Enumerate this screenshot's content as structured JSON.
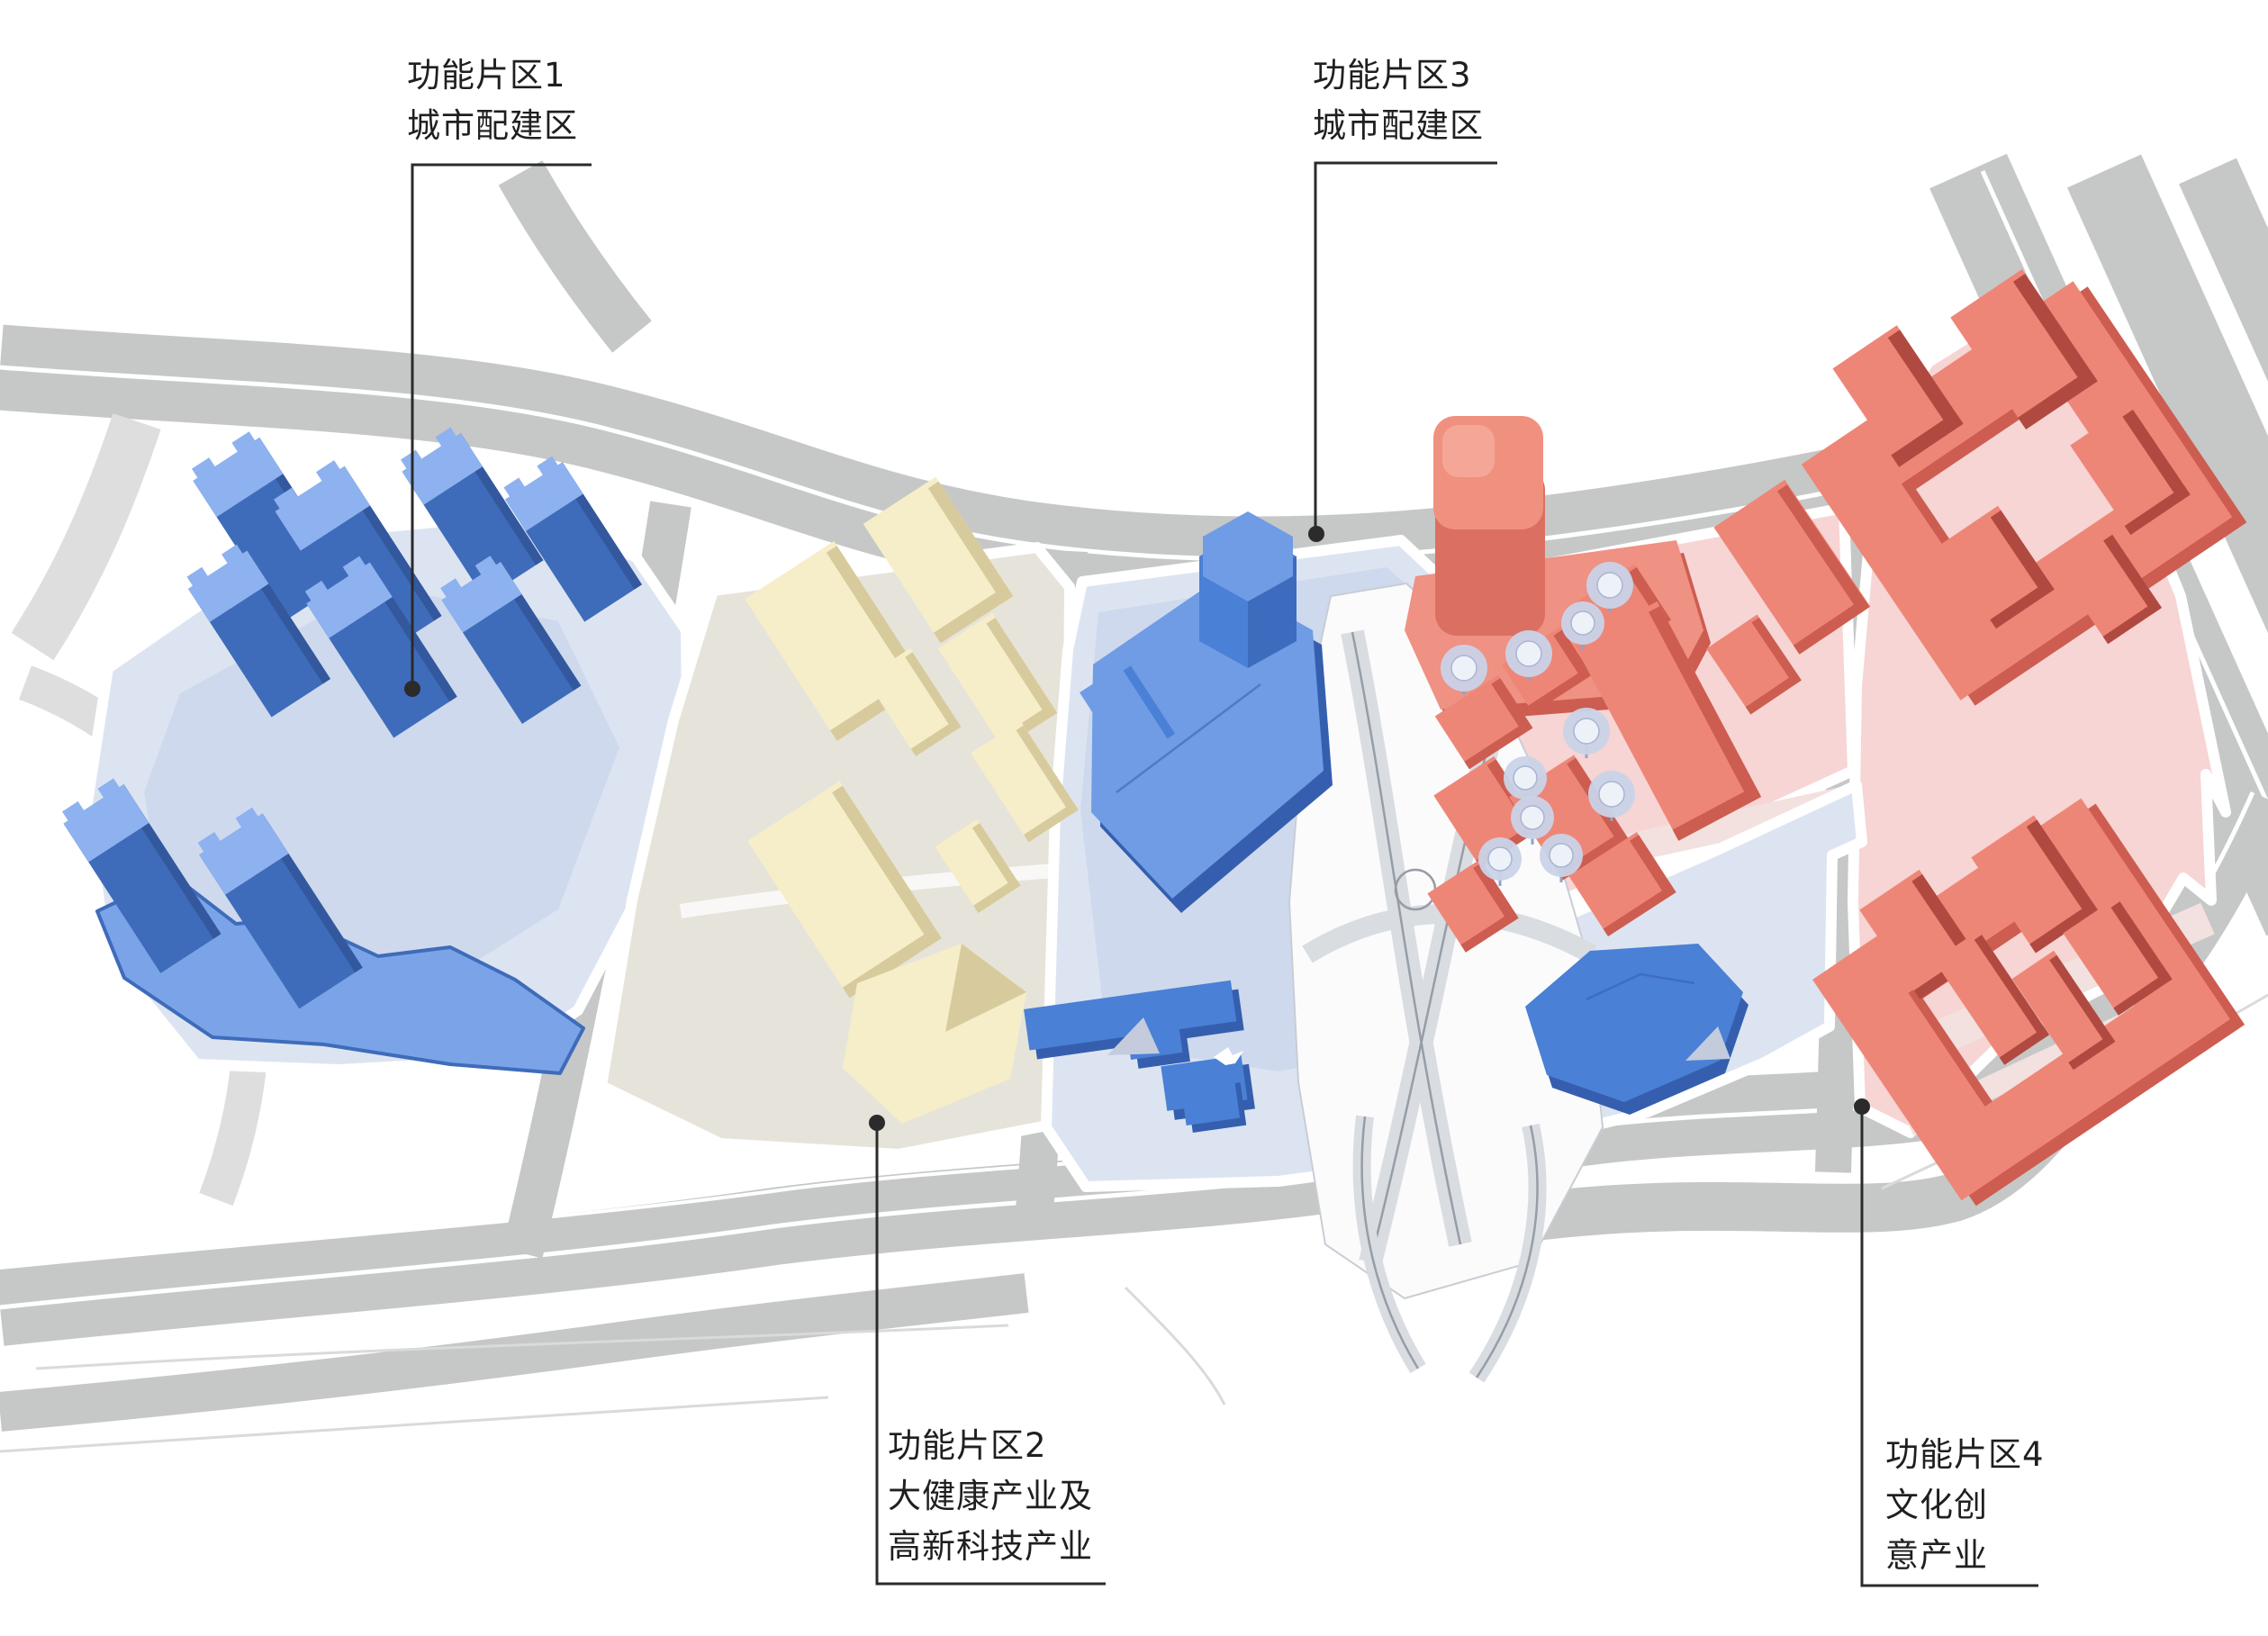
{
  "labels": [
    {
      "id": "zone-1",
      "lines": [
        "功能片区1",
        "城市配建区"
      ]
    },
    {
      "id": "zone-2",
      "lines": [
        "功能片区2",
        "大健康产业及",
        "高新科技产业"
      ]
    },
    {
      "id": "zone-3",
      "lines": [
        "功能片区3",
        "城市配建区"
      ]
    },
    {
      "id": "zone-4",
      "lines": [
        "功能片区4",
        "文化创",
        "意产业"
      ]
    }
  ],
  "colors": {
    "background": "#ffffff",
    "text": "#1f1f1f",
    "leader": "#2b2b2b",
    "road": "#c6c7c7",
    "road_light": "#dedede",
    "faint": "#dadada",
    "parcel_blue": "#dde4f1",
    "parcel_blue_inner": "#cbd7ec",
    "parcel_cream": "#e6e4da",
    "parcel_pink": "#f6d5d4",
    "pink_stripe": "#f2e1df",
    "wedge": "#fbfbfc",
    "interchange_band": "#d9dce1",
    "interchange_line": "#979da6",
    "blue_body": "#3e6cba",
    "blue_roof": "#8db2ef",
    "blue_dark": "#33589d",
    "blue_podium": "#7ba4e8",
    "bright_blue_body": "#4a80d6",
    "bright_blue_roof": "#6f9ce4",
    "bright_blue_dark": "#355fae",
    "cream_roof": "#f6eec9",
    "cream_side": "#d7cb9e",
    "red_roof": "#ee8677",
    "red_side": "#cd5d51",
    "red_dark": "#b04a40",
    "red_podium": "#ef9183",
    "canopy": "#c9d3e8",
    "triangle": "#c3cbdd"
  }
}
